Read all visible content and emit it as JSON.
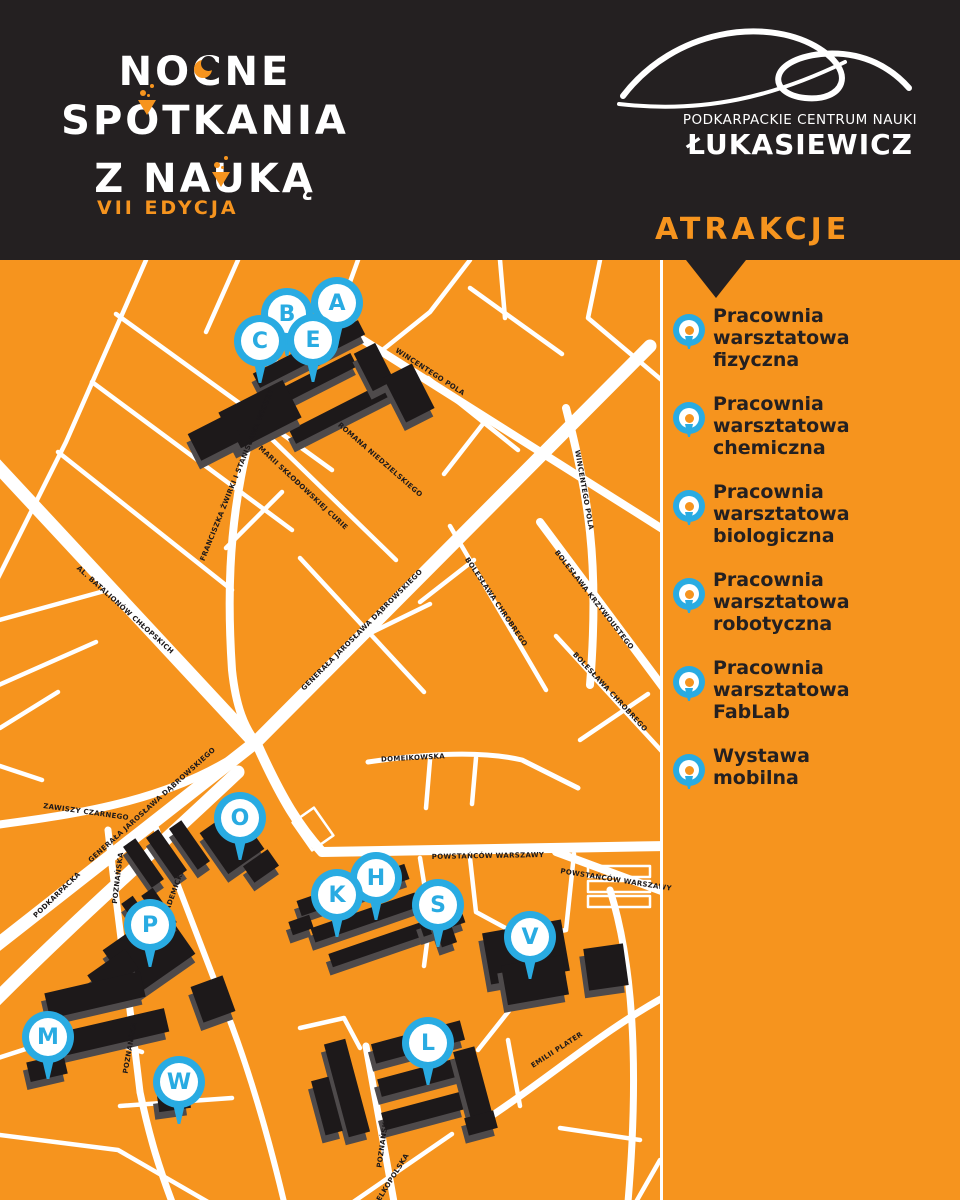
{
  "header": {
    "title_line1": "NOCNE",
    "title_line2": "SPOTKANIA",
    "title_line3": "Z NAUKĄ",
    "edition": "VII EDYCJA",
    "org_name_small": "PODKARPACKIE CENTRUM NAUKI",
    "org_name_large": "ŁUKASIEWICZ",
    "attractions_heading": "ATRAKCJE"
  },
  "colors": {
    "orange": "#F6941E",
    "blue": "#29ABE2",
    "dark": "#242021",
    "building": "#1D191A",
    "building_shadow": "#4E4A4B",
    "road": "#FFFFFF"
  },
  "sidebar": {
    "items": [
      {
        "label": "Pracownia\nwarsztatowa\nfizyczna"
      },
      {
        "label": "Pracownia\nwarsztatowa\nchemiczna"
      },
      {
        "label": "Pracownia\nwarsztatowa\nbiologiczna"
      },
      {
        "label": "Pracownia\nwarsztatowa\nrobotyczna"
      },
      {
        "label": "Pracownia\nwarsztatowa\nFabLab"
      },
      {
        "label": "Wystawa\nmobilna"
      }
    ]
  },
  "map": {
    "pins": [
      {
        "letter": "A",
        "x": 337,
        "y": 43
      },
      {
        "letter": "B",
        "x": 287,
        "y": 54
      },
      {
        "letter": "C",
        "x": 260,
        "y": 81
      },
      {
        "letter": "E",
        "x": 313,
        "y": 80
      },
      {
        "letter": "O",
        "x": 240,
        "y": 558
      },
      {
        "letter": "H",
        "x": 376,
        "y": 618
      },
      {
        "letter": "K",
        "x": 337,
        "y": 635
      },
      {
        "letter": "S",
        "x": 438,
        "y": 645
      },
      {
        "letter": "P",
        "x": 150,
        "y": 665
      },
      {
        "letter": "V",
        "x": 530,
        "y": 677
      },
      {
        "letter": "M",
        "x": 48,
        "y": 777
      },
      {
        "letter": "L",
        "x": 428,
        "y": 783
      },
      {
        "letter": "W",
        "x": 179,
        "y": 822
      }
    ],
    "street_labels": [
      {
        "text": "WINCENTEGO POLA",
        "x": 430,
        "y": 112,
        "angle": 33
      },
      {
        "text": "ROMANA NIEDZIELSKIEGO",
        "x": 380,
        "y": 200,
        "angle": 41
      },
      {
        "text": "FRANCISZKA ŻWIRKI I STANISŁAWA WIGURY",
        "x": 237,
        "y": 215,
        "angle": -68
      },
      {
        "text": "MARII SKŁODOWSKIEJ CURIE",
        "x": 303,
        "y": 228,
        "angle": 43
      },
      {
        "text": "WINCENTEGO POLA",
        "x": 584,
        "y": 230,
        "angle": 80
      },
      {
        "text": "BOLESŁAWA CHROBREGO",
        "x": 496,
        "y": 342,
        "angle": 56
      },
      {
        "text": "BOLESŁAWA KRZYWOUSTEGO",
        "x": 594,
        "y": 340,
        "angle": 52
      },
      {
        "text": "GENERAŁA JAROSŁAWA DĄBROWSKIEGO",
        "x": 362,
        "y": 370,
        "angle": -45
      },
      {
        "text": "AL. BATALIONÓW CHŁOPSKICH",
        "x": 125,
        "y": 350,
        "angle": 42
      },
      {
        "text": "BOLESŁAWA CHROBREGO",
        "x": 610,
        "y": 432,
        "angle": 47
      },
      {
        "text": "DOMEIKOWSKA",
        "x": 413,
        "y": 498,
        "angle": -3
      },
      {
        "text": "GENERAŁA JAROSŁAWA DĄBROWSKIEGO",
        "x": 152,
        "y": 545,
        "angle": -42
      },
      {
        "text": "ZAWISZY CZARNEGO",
        "x": 86,
        "y": 552,
        "angle": 8
      },
      {
        "text": "POWSTAŃCÓW WARSZAWY",
        "x": 488,
        "y": 596,
        "angle": -1
      },
      {
        "text": "POWSTAŃCÓW WARSZAWY",
        "x": 616,
        "y": 620,
        "angle": 9
      },
      {
        "text": "POZNAŃSKA",
        "x": 118,
        "y": 618,
        "angle": -83
      },
      {
        "text": "AKADEMICKA",
        "x": 173,
        "y": 635,
        "angle": -70
      },
      {
        "text": "PODKARPACKA",
        "x": 57,
        "y": 635,
        "angle": -44
      },
      {
        "text": "POZNAŃSKA",
        "x": 130,
        "y": 788,
        "angle": -80
      },
      {
        "text": "EMILII PLATER",
        "x": 557,
        "y": 790,
        "angle": -33
      },
      {
        "text": "POZNAŃSKA",
        "x": 383,
        "y": 882,
        "angle": -82
      },
      {
        "text": "WIELKOPOLSKA",
        "x": 390,
        "y": 922,
        "angle": -58
      }
    ]
  }
}
